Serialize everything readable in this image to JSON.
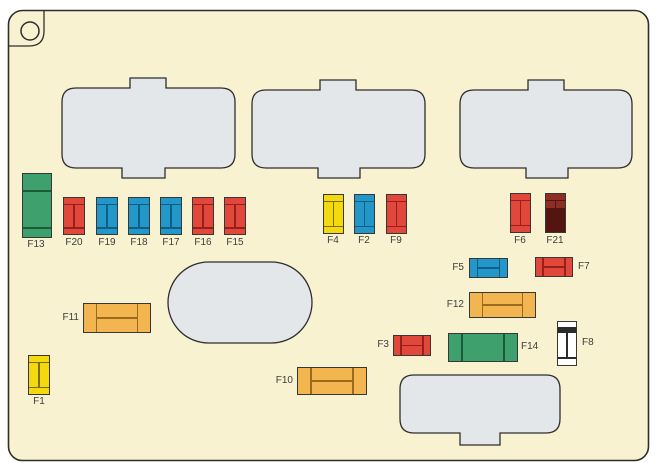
{
  "diagram_type": "fuse-box-diagram",
  "palette": {
    "page_background": "#FFFFFF",
    "panel_fill": "#F9F2D0",
    "panel_outline": "#2E2E2E",
    "slot_fill": "#E4E7EA",
    "label_color": "#3D3D3D",
    "fuse_red": "#E2473C",
    "fuse_blue": "#2397C9",
    "fuse_yellow": "#F4D90F",
    "fuse_green": "#3EA06C",
    "fuse_dark_red": "#8E2D23",
    "fuse_orange": "#F2B54F",
    "fuse_white": "#FFFFFF"
  },
  "icons": {
    "screw_hole_icon": "outlined-circle-in-rounded-corner"
  },
  "slots": {
    "relay_slot_count": 3,
    "oval_slot_count": 1,
    "bottom_slot_count": 1
  },
  "fuses": {
    "F13": {
      "label": "F13",
      "color": "green",
      "shape": "tall-vertical"
    },
    "F20": {
      "label": "F20",
      "color": "red",
      "shape": "vertical"
    },
    "F19": {
      "label": "F19",
      "color": "blue",
      "shape": "vertical"
    },
    "F18": {
      "label": "F18",
      "color": "blue",
      "shape": "vertical"
    },
    "F17": {
      "label": "F17",
      "color": "blue",
      "shape": "vertical"
    },
    "F16": {
      "label": "F16",
      "color": "red",
      "shape": "vertical"
    },
    "F15": {
      "label": "F15",
      "color": "red",
      "shape": "vertical"
    },
    "F4": {
      "label": "F4",
      "color": "yellow",
      "shape": "vertical"
    },
    "F2": {
      "label": "F2",
      "color": "blue",
      "shape": "vertical"
    },
    "F9": {
      "label": "F9",
      "color": "red",
      "shape": "vertical"
    },
    "F6": {
      "label": "F6",
      "color": "red",
      "shape": "vertical"
    },
    "F21": {
      "label": "F21",
      "color": "dark_red",
      "shape": "vertical"
    },
    "F5": {
      "label": "F5",
      "color": "blue",
      "shape": "horizontal"
    },
    "F7": {
      "label": "F7",
      "color": "red",
      "shape": "horizontal"
    },
    "F12": {
      "label": "F12",
      "color": "orange",
      "shape": "horizontal"
    },
    "F3": {
      "label": "F3",
      "color": "red",
      "shape": "horizontal"
    },
    "F14": {
      "label": "F14",
      "color": "green",
      "shape": "horizontal"
    },
    "F8": {
      "label": "F8",
      "color": "white",
      "shape": "vertical"
    },
    "F11": {
      "label": "F11",
      "color": "orange",
      "shape": "horizontal"
    },
    "F1": {
      "label": "F1",
      "color": "yellow",
      "shape": "vertical"
    },
    "F10": {
      "label": "F10",
      "color": "orange",
      "shape": "horizontal"
    }
  }
}
